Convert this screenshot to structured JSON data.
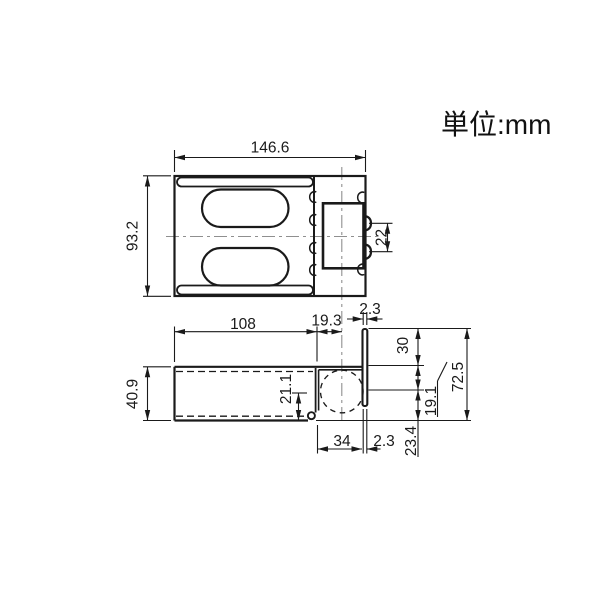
{
  "unit_note": "単位:mm",
  "colors": {
    "line": "#1a1a1a",
    "centerline": "#8f8f8f",
    "background": "#ffffff"
  },
  "top_view": {
    "overall_width": "146.6",
    "overall_height": "93.2",
    "emboss_pitch": "22"
  },
  "side_view": {
    "body_length": "108",
    "center_offset": "19.3",
    "plate_thickness_top": "2.3",
    "flange_upper_height": "30",
    "overall_height": "72.5",
    "flange_mid_height": "19.1",
    "flange_lower_height": "23.4",
    "channel_height": "40.9",
    "center_from_bottom": "21.1",
    "step_width": "34",
    "plate_thickness_bottom": "2.3"
  }
}
